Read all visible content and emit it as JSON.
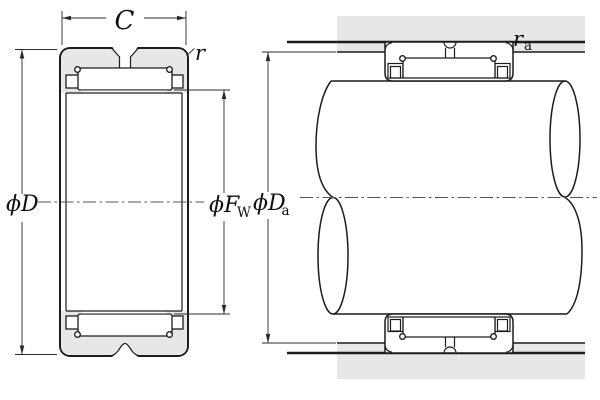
{
  "diagram": {
    "colors": {
      "shading": "#e7e7e7",
      "line": "#1c1c1c",
      "dim": "#2b2b2b",
      "background": "#ffffff"
    },
    "labels": {
      "width": "C",
      "chamfer_radius": "r",
      "outer_diameter": "ϕD",
      "raceway_diameter_main": "ϕF",
      "raceway_diameter_sub": "W",
      "abutment_diameter_main": "ϕD",
      "abutment_diameter_sub": "a",
      "fillet_radius_main": "r",
      "fillet_radius_sub": "a"
    }
  }
}
